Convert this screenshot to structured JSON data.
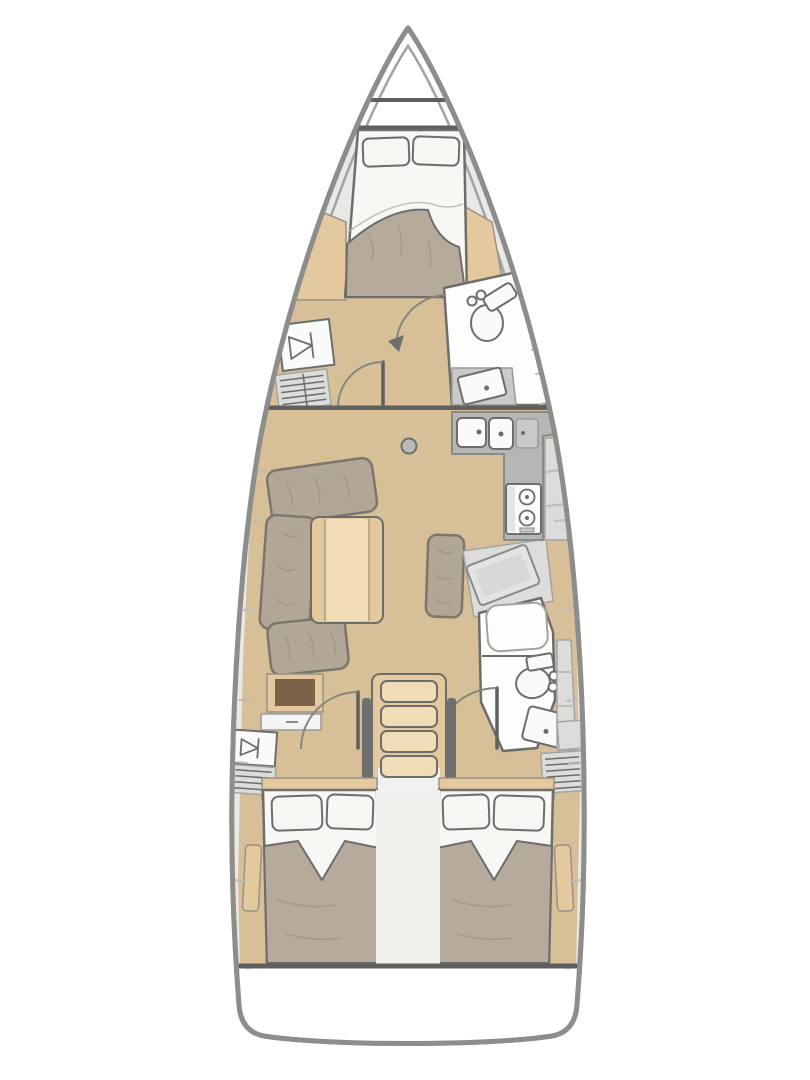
{
  "diagram": {
    "kind": "sailboat-interior-floor-plan",
    "orientation": "bow-up",
    "palette": {
      "hull_stroke": "#8d8d8b",
      "hull_inner_stroke": "#a3a3a1",
      "deck": "#e8e8e6",
      "deck_panel": "#dcdcda",
      "seam": "#bdbdbb",
      "floor": "#d7bf98",
      "wood": "#e4c99e",
      "wood_light": "#f0ddb8",
      "wood_dark": "#7b6249",
      "cushion": "#b2a796",
      "cushion_stroke": "#7b766c",
      "streak": "#968b7c",
      "bedding": "#f8f7f4",
      "blanket": "#b5aa9b",
      "white_floor": "#fdfdfc",
      "fixture_stroke": "#6d6d6b",
      "counter": "#b6b6b4",
      "counter_light": "#c9c9c7",
      "steel_dark": "#6f6f6d",
      "line_dark": "#5f5f5d",
      "appliance_white": "#fafaf9",
      "background": "#ffffff"
    },
    "areas": [
      {
        "name": "anchor-locker",
        "fixtures": [
          "bulkhead-line",
          "bulkhead-line"
        ]
      },
      {
        "name": "forward-cabin",
        "fixtures": [
          "double-berth",
          "pillow",
          "pillow",
          "blanket",
          "hanging-locker",
          "louvered-locker",
          "door-swing"
        ]
      },
      {
        "name": "forward-head",
        "fixtures": [
          "toilet",
          "vanity-sink",
          "door-swing",
          "side-lockers"
        ]
      },
      {
        "name": "saloon",
        "fixtures": [
          "l-shaped-sofa",
          "saloon-table",
          "ottoman-bench",
          "mast-post",
          "storage-cabinet",
          "drawer"
        ]
      },
      {
        "name": "galley",
        "fixtures": [
          "double-sink",
          "worktop",
          "two-burner-stove",
          "side-lockers"
        ]
      },
      {
        "name": "nav-station",
        "fixtures": [
          "chart-table",
          "seat-platform"
        ]
      },
      {
        "name": "aft-head",
        "fixtures": [
          "shower",
          "toilet",
          "sink",
          "door-swing",
          "side-lockers"
        ]
      },
      {
        "name": "companionway",
        "fixtures": [
          "steps",
          "handrail",
          "handrail",
          "door-swing",
          "door-swing"
        ]
      },
      {
        "name": "aft-cabin-port",
        "fixtures": [
          "double-berth",
          "pillow",
          "pillow",
          "blanket",
          "hanging-locker",
          "louvered-locker",
          "side-shelf"
        ]
      },
      {
        "name": "aft-cabin-starboard",
        "fixtures": [
          "double-berth",
          "pillow",
          "pillow",
          "blanket",
          "locker",
          "louvered-locker",
          "side-shelf"
        ]
      },
      {
        "name": "transom"
      }
    ]
  }
}
